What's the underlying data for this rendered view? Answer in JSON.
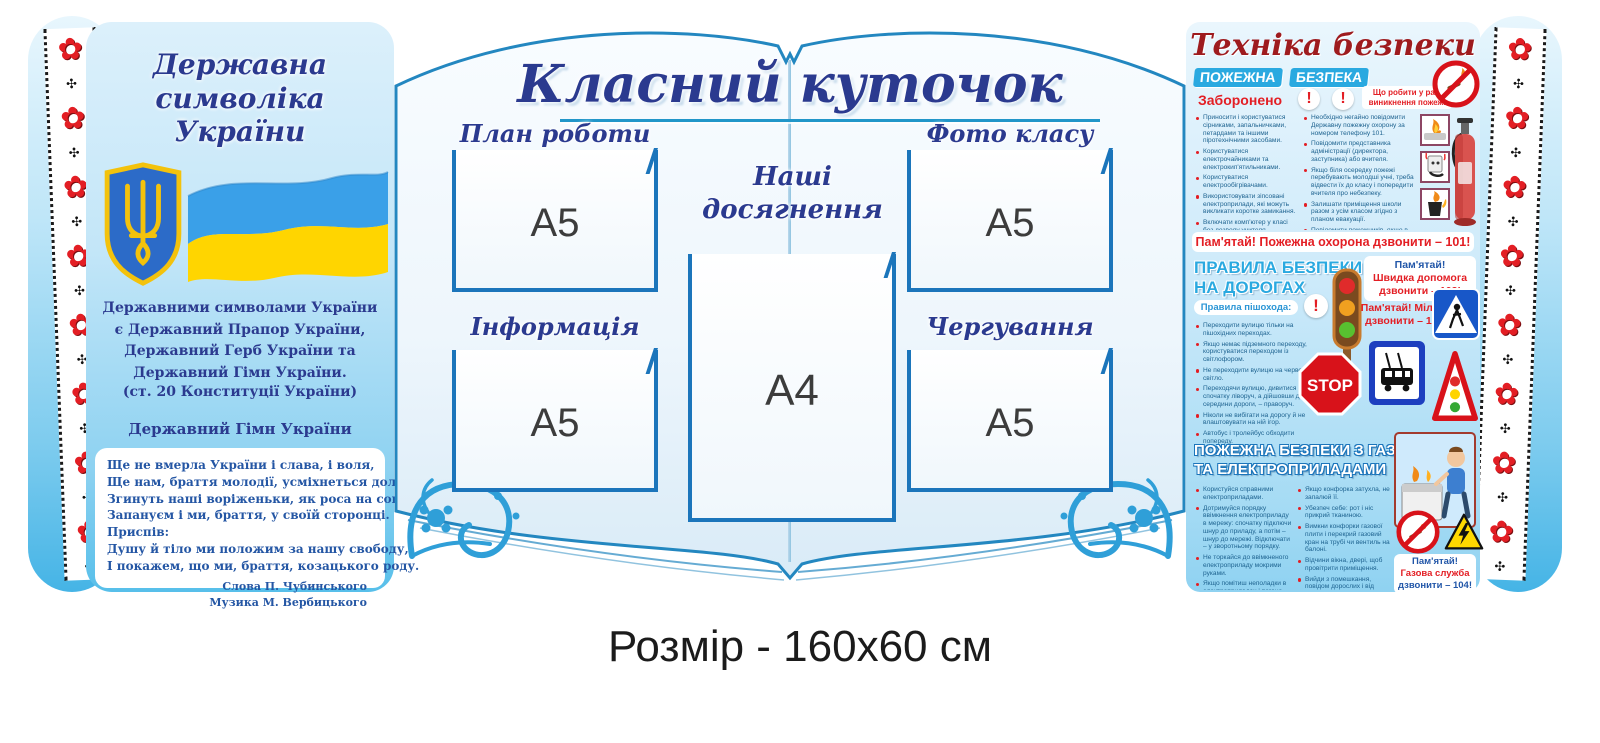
{
  "caption": "Розмір - 160x60 см",
  "icons": {
    "embroidery_flower": "✿",
    "embroidery_accent": "✣",
    "exclamation": "!"
  },
  "left_panel": {
    "title_lines": [
      "Державна",
      "символіка",
      "України"
    ],
    "symbols_paragraph": "Державними символами України є Державний Прапор України, Державний Герб України та Державний Гімн України.",
    "constitution_note": "(ст. 20 Конституції України)",
    "anthem_heading": "Державний Гімн України",
    "anthem_lines": [
      "Ще не вмерла України і слава, і воля,",
      "Ще нам, браття молодії, усміхнеться доля.",
      "Згинуть наші воріженьки, як роса на сонці.",
      "Запануєм і ми, браття, у своїй сторонці.",
      "Приспів:",
      "Душу й тіло ми положим за нашу свободу,",
      "І покажем, що ми, браття, козацького роду."
    ],
    "credit_lines": [
      "Слова П. Чубинського",
      "Музика М. Вербицького"
    ]
  },
  "center": {
    "title": "Класний куточок",
    "labels": {
      "plan": "План роботи",
      "photo": "Фото класу",
      "achievements_lines": [
        "Наші",
        "досягнення"
      ],
      "info": "Інформація",
      "duty": "Чергування"
    },
    "sizes": {
      "a5": "A5",
      "a4": "A4"
    }
  },
  "right_panel": {
    "title": "Техніка безпеки",
    "fire": {
      "heading_words": [
        "ПОЖЕЖНА",
        "БЕЗПЕКА"
      ],
      "forbidden_label": "Заборонено",
      "actions_label": "Що робити у разі виникнення пожежі",
      "forbidden_items": [
        "Приносити і користуватися сірниками, запальничками, петардами та іншими піротехнічними засобами.",
        "Користуватися електрочайниками та електрокип'ятильниками.",
        "Користуватися електрообігрівачами.",
        "Використовувати зіпсовані електроприлади, які можуть викликати коротке замикання.",
        "Включати комп'ютер у класі без дозволу учителя."
      ],
      "action_items": [
        "Необхідно негайно повідомити Державну пожежну охорону за номером телефону 101.",
        "Повідомити представника адміністрації (директора, заступника) або вчителя.",
        "Якщо біля осередку пожежі перебувають молодші учні, треба відвести їх до класу і попередити вчителя про небезпеку.",
        "Залишати приміщення школи разом з усім класом згідно з планом евакуації.",
        "Повідомити пожежників, якщо в цьому буде потреба, про місце й обставини виникнення пожежі."
      ],
      "reminder": "Пам'ятай! Пожежна охорона дзвонити – 101!"
    },
    "road": {
      "heading_lines": [
        "ПРАВИЛА БЕЗПЕКИ",
        "НА ДОРОГАХ"
      ],
      "pedestrian_label": "Правила пішохода:",
      "items": [
        "Переходити вулицю тільки на пішохідних переходах.",
        "Якщо немає підземного переходу, користуватися переходом із світлофором.",
        "Не переходити вулицю на червоне світло.",
        "Переходячи вулицю, дивитися спочатку ліворуч, а дійшовши до середини дороги, – праворуч.",
        "Ніколи не вибігати на дорогу й не влаштовувати на ній ігор.",
        "Автобус і тролейбус обходити попереду.",
        "Трамвай обходити позаду."
      ],
      "ambulance_lines": [
        "Пам'ятай!",
        "Швидка допомога",
        "дзвонити – 103!"
      ],
      "police_lines": [
        "Пам'ятай! Міліція",
        "дзвонити – 102!"
      ],
      "stop_sign": "STOP"
    },
    "gas": {
      "heading_lines": [
        "ПОЖЕЖНА БЕЗПЕКИ З ГАЗО-",
        "ТА ЕЛЕКТРОПРИЛАДАМИ"
      ],
      "left_items": [
        "Користуйся справними електроприладами.",
        "Дотримуйся порядку ввімкнення електроприладу в мережу: спочатку підключи шнур до приладу, а потім – шнур до мережі. Відключати – у зворотньому порядку.",
        "Не торкайся до ввімкненого електроприладу мокрими руками.",
        "Якщо помітиш неполадки в електроприладах і погано ізольовані, обірвані чи проіскрені дроти, негайно повідомляйте батькам чи старшим."
      ],
      "right_items": [
        "Якщо конфорка затухла, не запалюй її.",
        "Убезпеч себе: рот і ніс прикрий тканиною.",
        "Вимкни конфорки газової плити і перекрий газовий кран на трубі чи вентиль на балоні.",
        "Відчини вікна, двері, щоб провітрити приміщення.",
        "Вийди з помешкання, повідом дорослих і від сусідів виклич аварійну газову службу за телефоном 104."
      ],
      "reminder_lines": [
        "Пам'ятай!",
        "Газова служба",
        "дзвонити – 104!"
      ]
    }
  }
}
